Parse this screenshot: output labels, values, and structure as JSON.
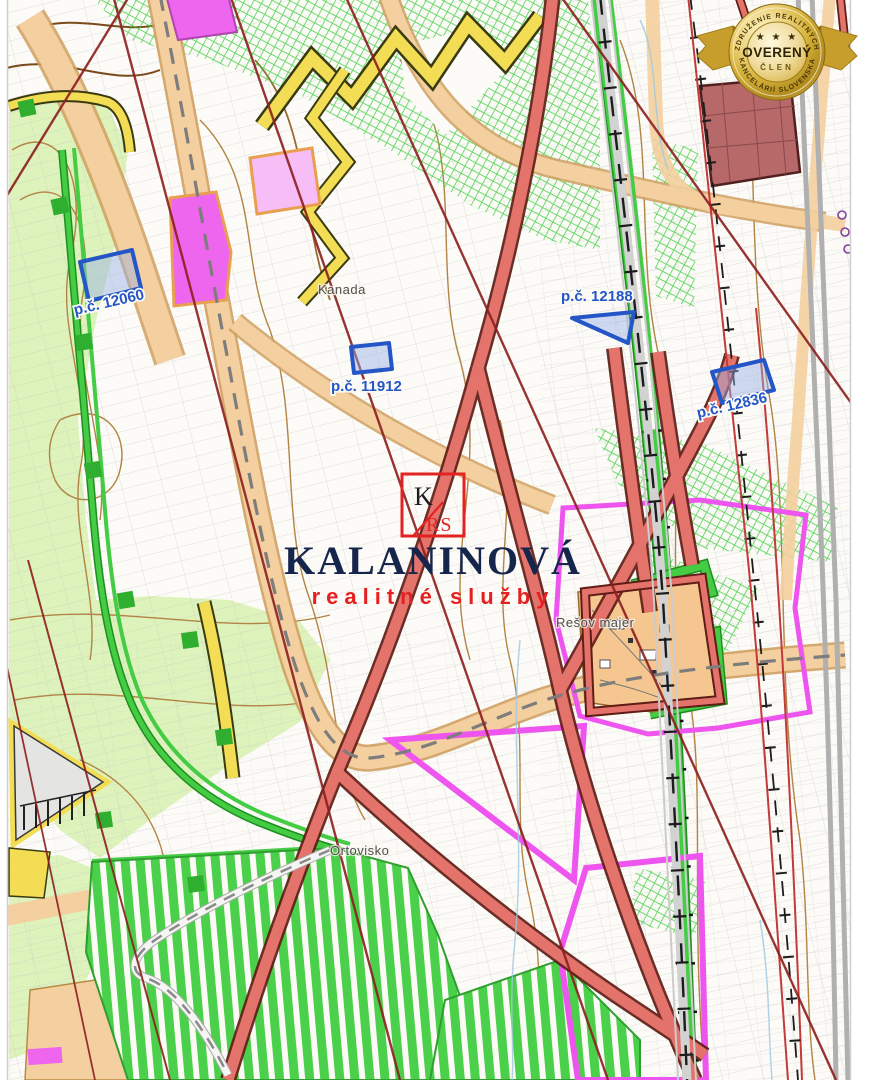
{
  "map": {
    "parcel_markers": [
      {
        "label": "p.č. 12060"
      },
      {
        "label": "p.č. 11912"
      },
      {
        "label": "p.č. 12188"
      },
      {
        "label": "p.č. 12836"
      }
    ],
    "place_labels": [
      {
        "name": "Kanada"
      },
      {
        "name": "Rešov majer"
      },
      {
        "name": "Ortovisko"
      }
    ]
  },
  "watermark": {
    "monogram_top": "K",
    "monogram_bottom": "RS",
    "brand": "KALANINOVÁ",
    "tagline": "realitné služby"
  },
  "badge": {
    "arc_top": "ZDRUŽENIE REALITNÝCH",
    "stars": "★ ★ ★",
    "title": "OVERENÝ",
    "subtitle": "ČLEN",
    "arc_bottom": "KANCELÁRIÍ SLOVENSKA"
  },
  "colors": {
    "parcel_marker_blue": "#2456c8",
    "road_band_red": "#e4736b",
    "road_band_red_edge": "#5f1d15",
    "zone_magenta": "#ee55ee",
    "zone_green": "#45cc45",
    "zone_pale_green": "#ddf3bb",
    "zone_orange": "#f4cf9f",
    "zone_yellow": "#f2dd55",
    "contour_brown": "#b28445",
    "power_line_maroon": "#8c1f1f",
    "brand_navy": "#16254c",
    "brand_red": "#e62020",
    "badge_gold": "#d4af37"
  }
}
